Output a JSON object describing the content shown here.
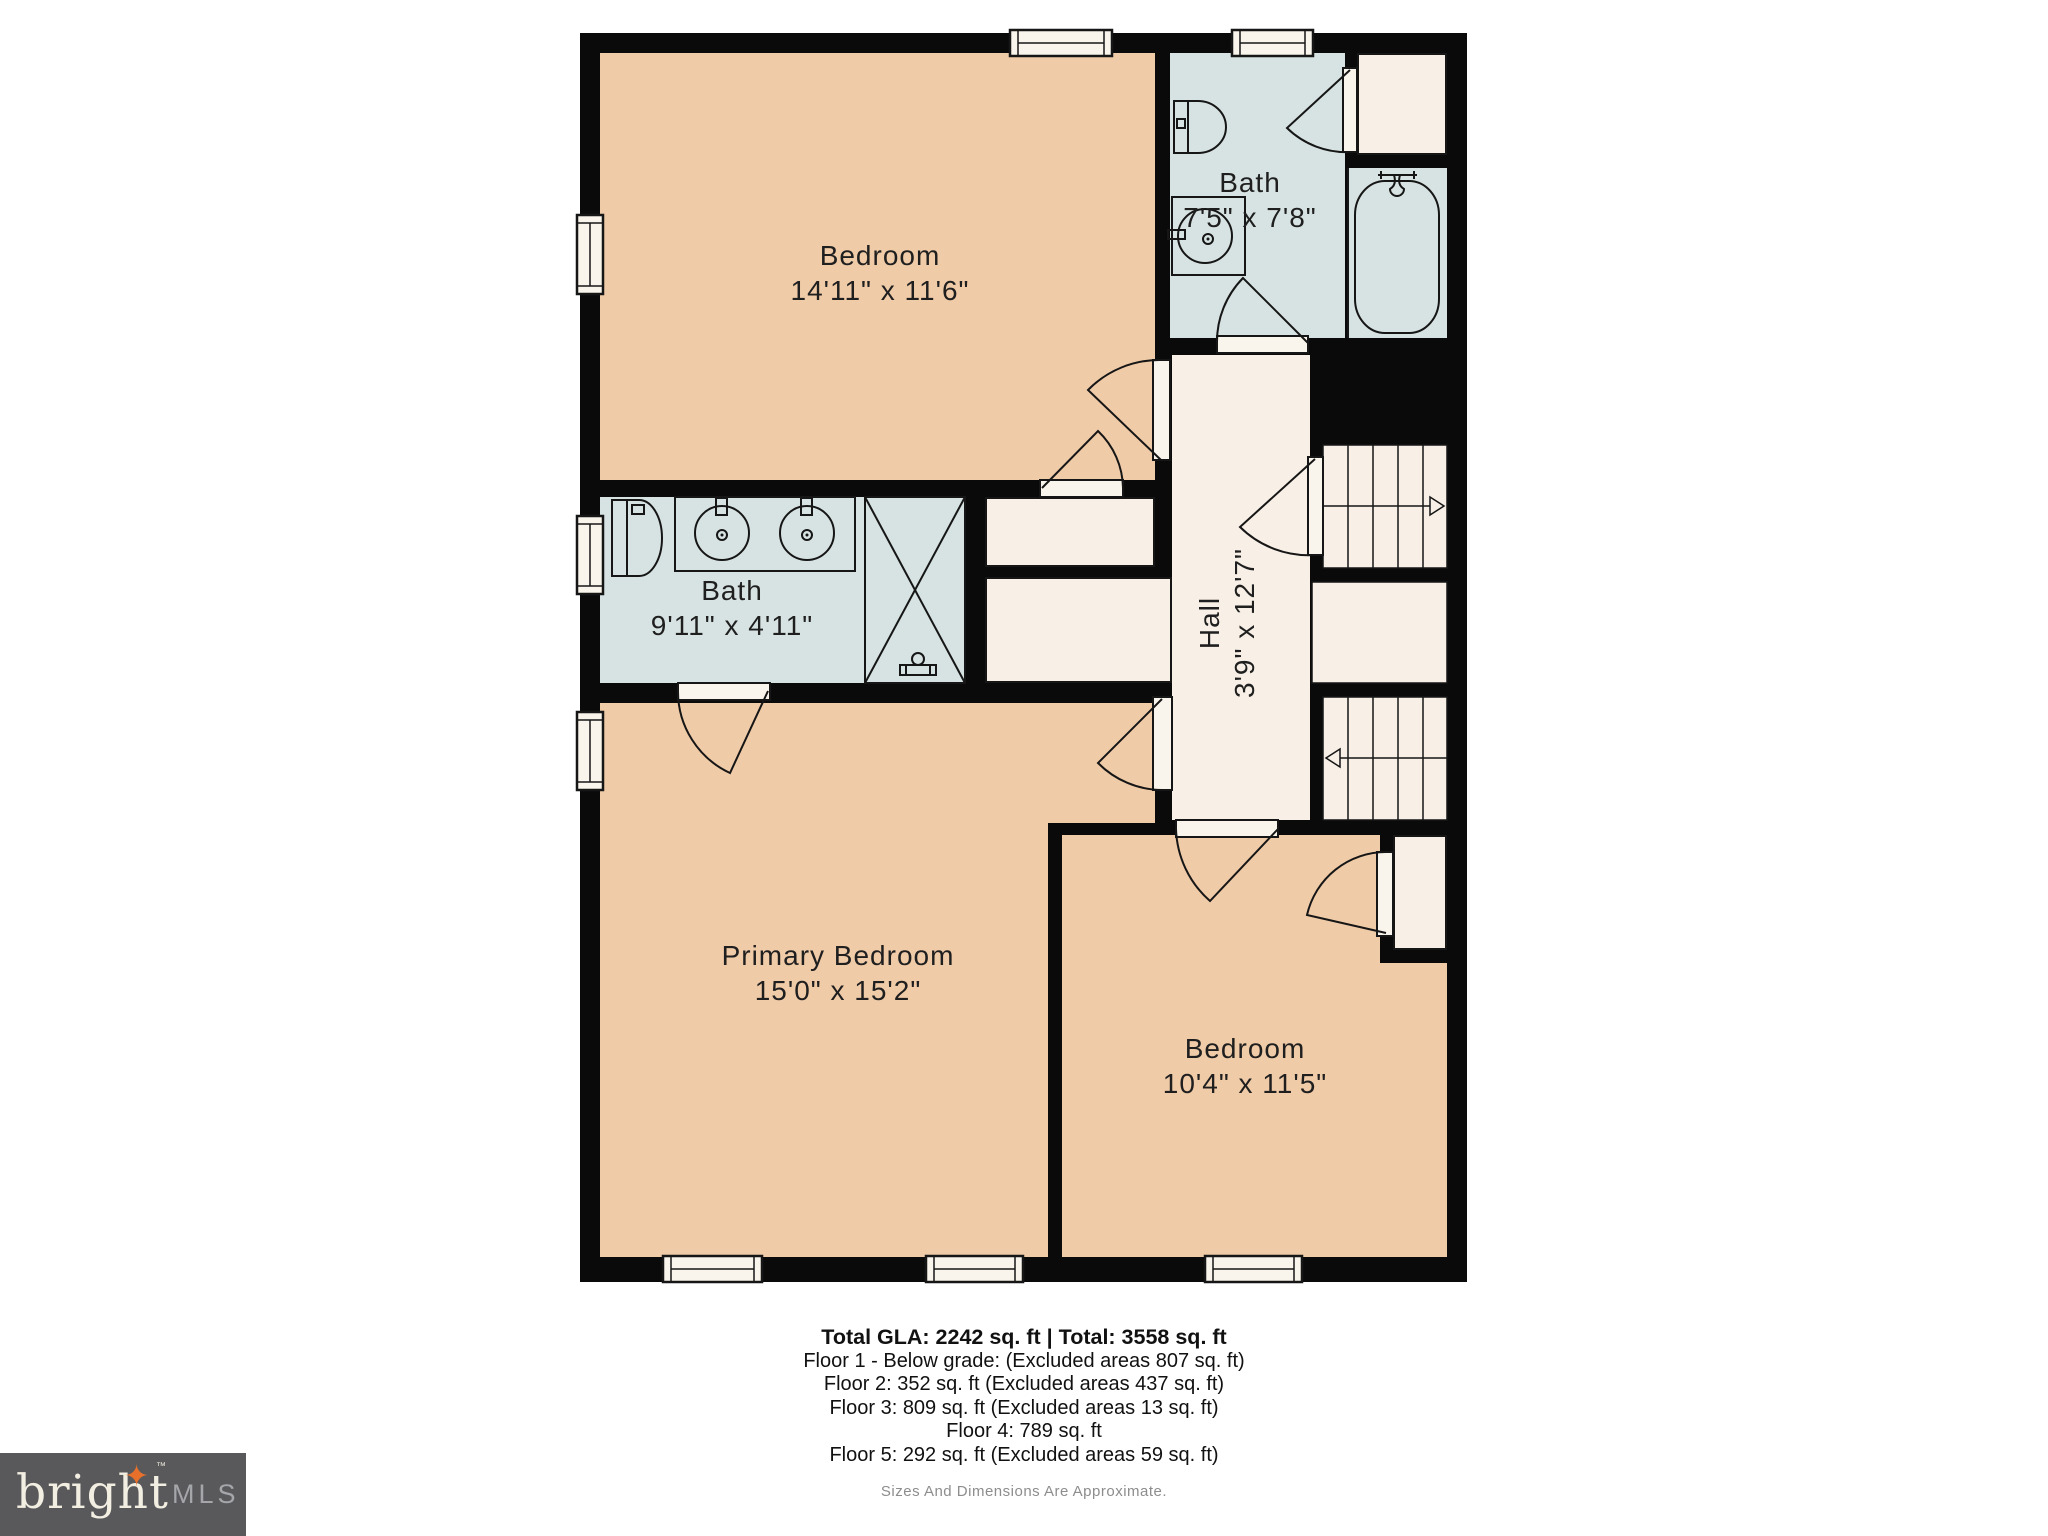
{
  "plan": {
    "rooms": {
      "bedroom_top": {
        "name": "Bedroom",
        "dims": "14'11\" x 11'6\""
      },
      "bath_top": {
        "name": "Bath",
        "dims": "7'5\" x 7'8\""
      },
      "bath_mid": {
        "name": "Bath",
        "dims": "9'11\" x 4'11\""
      },
      "hall": {
        "name": "Hall",
        "dims": "3'9\" x 12'7\""
      },
      "primary_bedroom": {
        "name": "Primary Bedroom",
        "dims": "15'0\" x 15'2\""
      },
      "bedroom_bottom": {
        "name": "Bedroom",
        "dims": "10'4\" x 11'5\""
      }
    },
    "colors": {
      "wall": "#0a0a0a",
      "room_peach": "#F0CBA8",
      "room_bath_blue": "#D7E3E2",
      "room_cream": "#F8EFE6",
      "logo_bg": "#59595C",
      "logo_orange": "#E8702A"
    }
  },
  "footer": {
    "total_line": "Total GLA: 2242 sq. ft | Total: 3558 sq. ft",
    "floor_lines": [
      "Floor 1 - Below grade: (Excluded areas 807 sq. ft)",
      "Floor 2: 352 sq. ft (Excluded areas 437 sq. ft)",
      "Floor 3: 809 sq. ft (Excluded areas 13 sq. ft)",
      "Floor 4: 789 sq. ft",
      "Floor 5: 292 sq. ft (Excluded areas 59 sq. ft)"
    ],
    "disclaimer": "Sizes And Dimensions Are Approximate."
  },
  "logo": {
    "brand": "bright",
    "star": "✦",
    "tm": "™",
    "suffix": "MLS"
  }
}
